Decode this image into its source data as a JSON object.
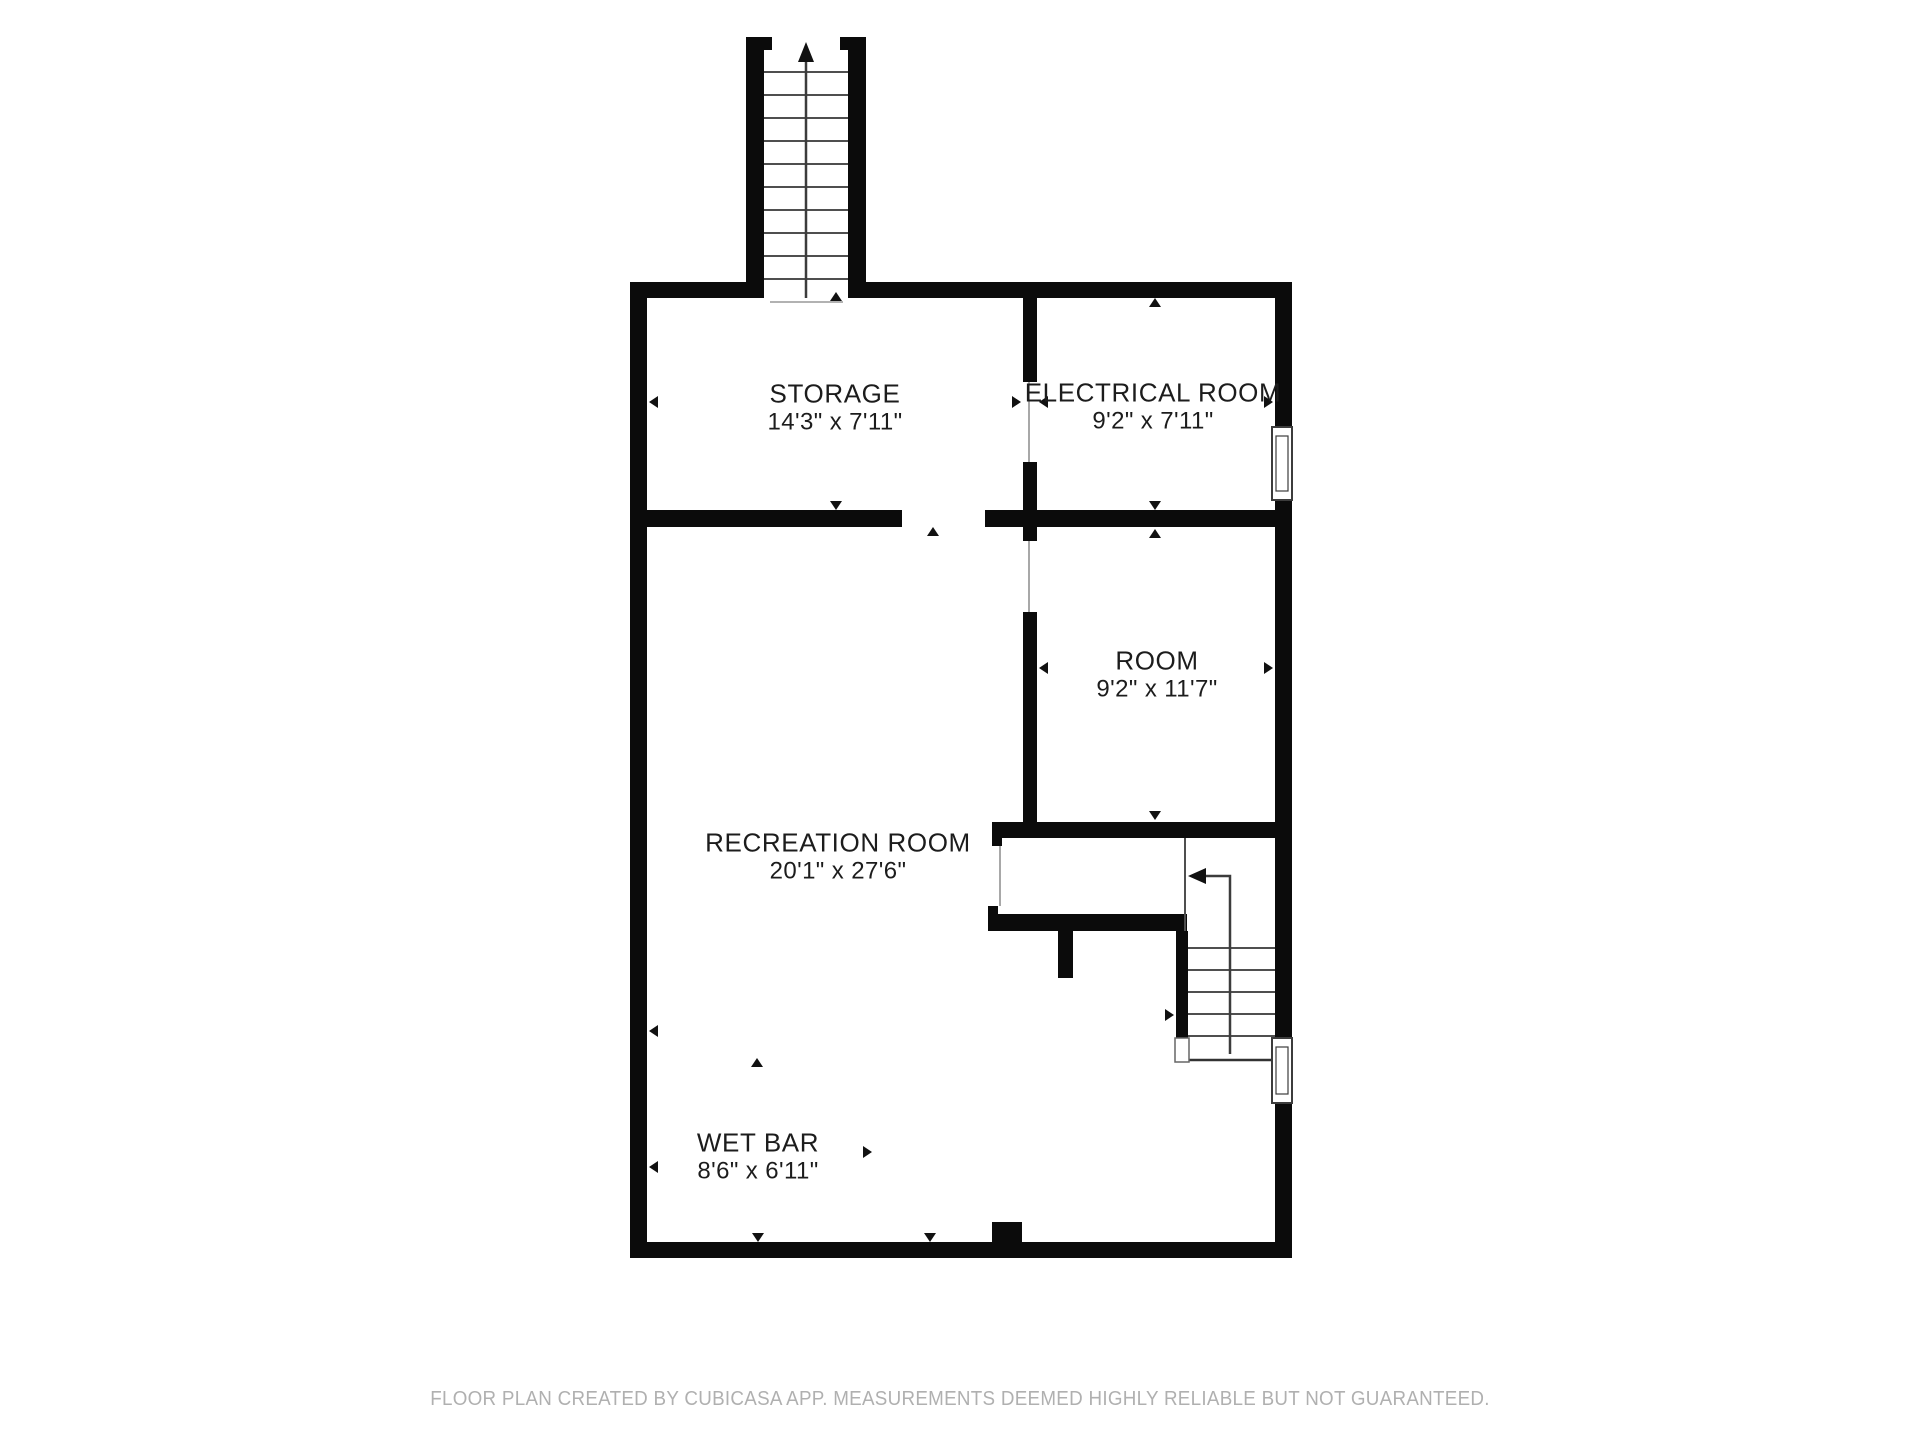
{
  "page": {
    "background_color": "#ffffff",
    "wall_color": "#0b0b0b",
    "thin_line_color": "#4f4f4f",
    "label_color": "#1c1c1c",
    "footer_color": "#b0b0b0"
  },
  "floor_plan": {
    "rooms": [
      {
        "id": "storage",
        "name": "STORAGE",
        "dimensions": "14'3\" x 7'11\""
      },
      {
        "id": "electrical-room",
        "name": "ELECTRICAL ROOM",
        "dimensions": "9'2\" x 7'11\""
      },
      {
        "id": "room",
        "name": "ROOM",
        "dimensions": "9'2\" x 11'7\""
      },
      {
        "id": "recreation-room",
        "name": "RECREATION ROOM",
        "dimensions": "20'1\" x 27'6\""
      },
      {
        "id": "wet-bar",
        "name": "WET BAR",
        "dimensions": "8'6\" x 6'11\""
      }
    ],
    "icons": {
      "stairs_direction": "stairs-up-arrow-icon",
      "window": "window-icon",
      "dimension_marker": "dimension-arrow-icon"
    }
  },
  "footer": {
    "text": "FLOOR PLAN CREATED BY CUBICASA APP. MEASUREMENTS DEEMED HIGHLY RELIABLE BUT NOT GUARANTEED."
  }
}
